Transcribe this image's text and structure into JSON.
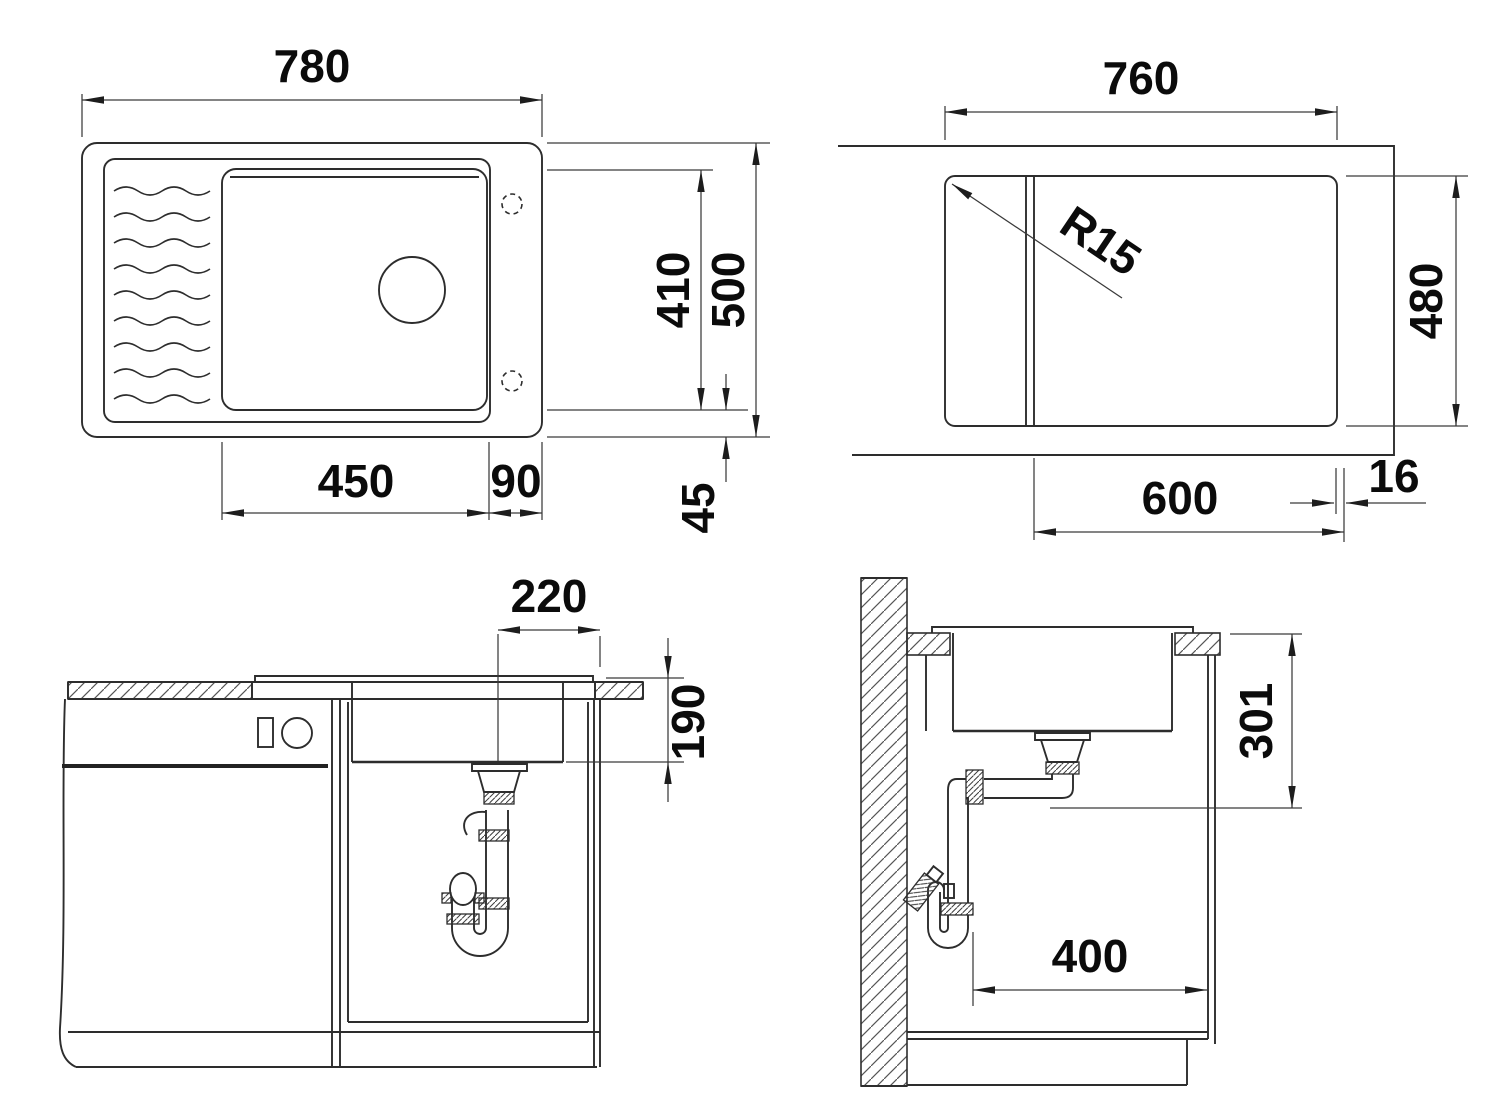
{
  "drawing": {
    "kind": "sink installation technical drawing",
    "line_color": "#2d2d2d",
    "text_color": "#0b0b0b",
    "views": {
      "sink_top": {
        "name": "sink top view",
        "dims": {
          "overall_width": "780",
          "overall_depth": "500",
          "bowl_depth": "410",
          "bowl_width": "450",
          "right_ledge": "90",
          "edge_margin": "45"
        }
      },
      "cutout_plan": {
        "name": "worktop cutout plan",
        "dims": {
          "cutout_width": "760",
          "cutout_depth": "480",
          "cabinet_width": "600",
          "panel_thickness": "16",
          "corner_radius": "R15"
        }
      },
      "front_section": {
        "name": "front section",
        "dims": {
          "drain_offset": "220",
          "depth_below_top": "190"
        }
      },
      "side_section": {
        "name": "side section",
        "dims": {
          "outlet_height": "301",
          "clearance_width": "400"
        }
      }
    }
  }
}
